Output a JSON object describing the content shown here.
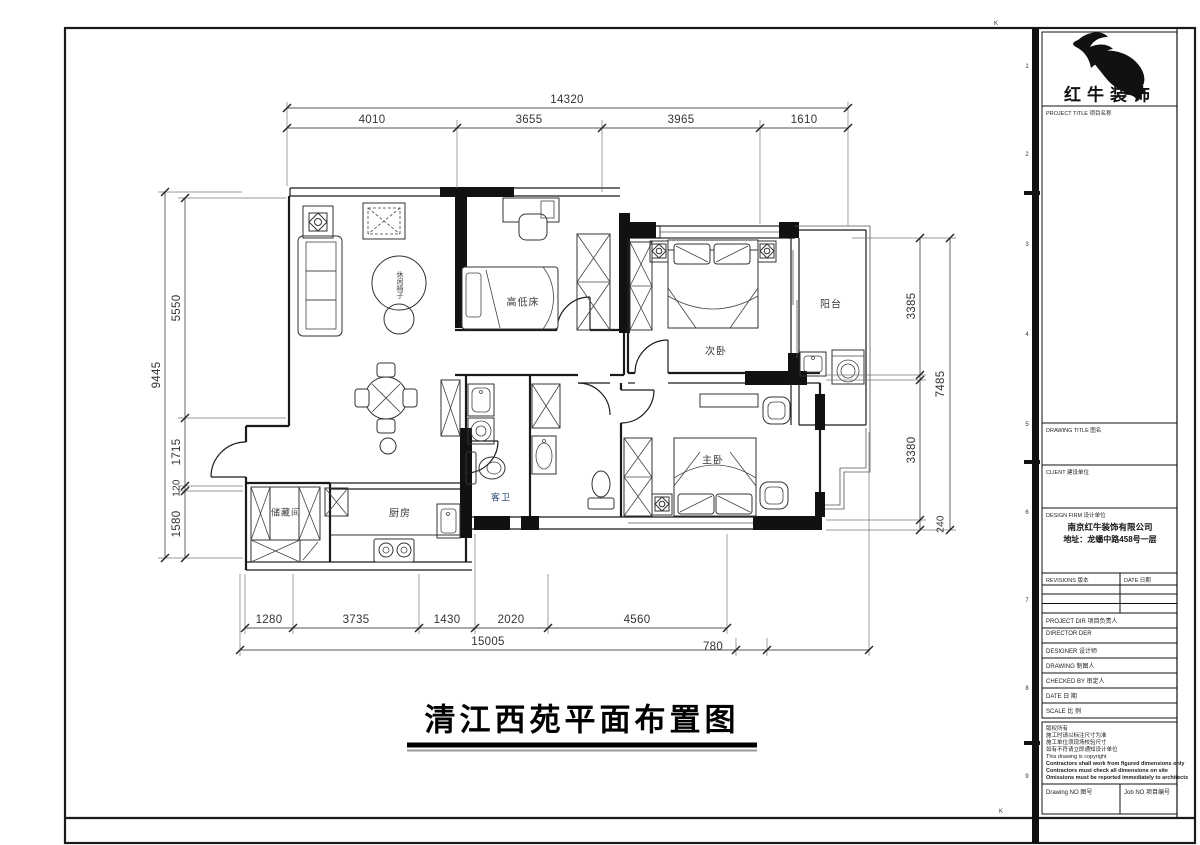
{
  "brand": {
    "name": "红牛装饰"
  },
  "plan": {
    "title": "清江西苑平面布置图",
    "rooms": {
      "kids_room": "高低床",
      "second_bedroom": "次卧",
      "balcony": "阳台",
      "master_bedroom": "主卧",
      "guest_bath": "客卫",
      "kitchen": "厨房",
      "storage": "储藏间",
      "leisure_chair": "休闲椅子"
    },
    "dims": {
      "top": {
        "overall": "14320",
        "seg1": "4010",
        "seg2": "3655",
        "seg3": "3965",
        "seg4": "1610"
      },
      "left": {
        "overall": "9445",
        "seg1": "5550",
        "seg2": "1715",
        "seg3": "120",
        "seg4": "1580"
      },
      "right": {
        "overall": "7485",
        "seg1": "3385",
        "seg2": "3380",
        "seg3": "240"
      },
      "bottom": {
        "seg1": "1280",
        "seg2": "3735",
        "seg3": "1430",
        "seg4": "2020",
        "seg5": "4560",
        "overall": "15005",
        "extra": "780"
      }
    },
    "zone": {
      "top_k": "K",
      "bottom_k": "K",
      "n": [
        "1",
        "2",
        "3",
        "4",
        "5",
        "6",
        "7",
        "8",
        "9"
      ]
    }
  },
  "tb": {
    "project_title_caption": "PROJECT TITLE 项目名称",
    "drawing_title_caption": "DRAWING TITLE 图名",
    "client_caption": "CLIENT 建设单位",
    "design_firm_caption": "DESIGN FIRM 设计单位",
    "design_firm_name": "南京红牛装饰有限公司",
    "design_firm_address": "地址：龙蟠中路458号一层",
    "revisions_caption": "REVISIONS 版本",
    "date_col_caption": "DATE 日期",
    "project_dir_caption": "PROJECT DIR 项目负责人",
    "director_caption": "DIRECTOR DER",
    "designer_caption": "DESIGNER 设计师",
    "drawing_by_caption": "DRAWING 制图人",
    "checked_by_caption": "CHECKED BY 审定人",
    "date_caption": "DATE 日 期",
    "scale_caption": "SCALE 比 例",
    "copyright_cn_1": "版权所有",
    "copyright_cn_2": "施工时请以标注尺寸为准",
    "copyright_cn_3": "施工单位须现场校验尺寸",
    "copyright_cn_4": "如有不符请立即通知设计单位",
    "copyright_en_1": "This drawing is copyright",
    "copyright_en_2": "Contractors shall work from figured dimensions only",
    "copyright_en_3": "Contractors must check all dimensions on site",
    "copyright_en_4": "Omissions must be reported immediately to architects",
    "drawing_no_caption": "Drawing NO 图号",
    "job_no_caption": "Job NO 项目编号"
  }
}
